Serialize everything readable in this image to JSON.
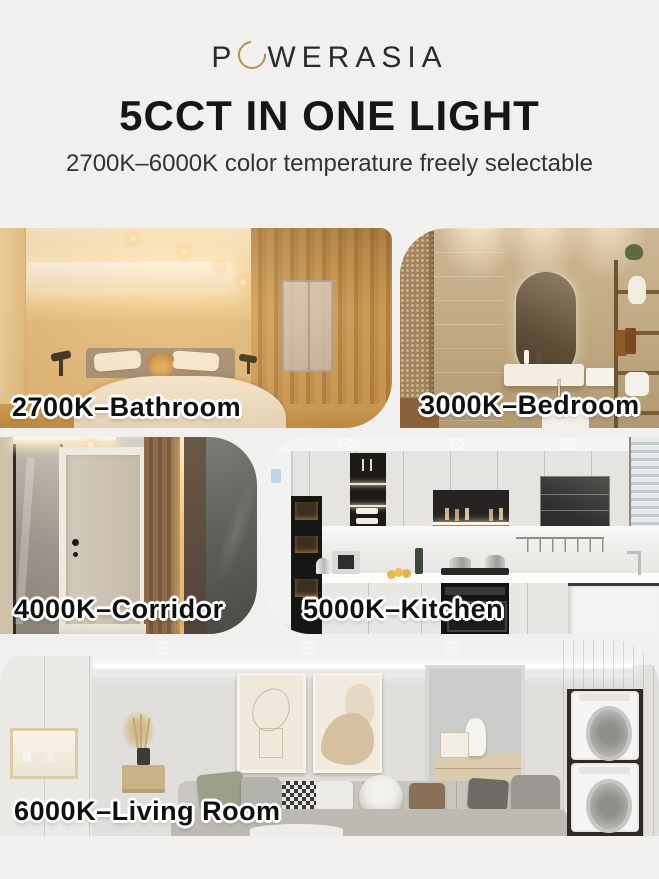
{
  "page": {
    "background": "#f1f0ee"
  },
  "brand": {
    "logo_pre_o": "P",
    "logo_post_o": "WERASIA",
    "logo_ring_color": "#b3924f",
    "logo_text_color": "#2b2b2b"
  },
  "header": {
    "title": "5CCT IN ONE LIGHT",
    "subtitle": "2700K–6000K color temperature freely selectable"
  },
  "scenes": [
    {
      "label": "2700K–Bathroom",
      "cct": "2700K",
      "room": "Bathroom",
      "tone_color": "#e3bd84"
    },
    {
      "label": "3000K–Bedroom",
      "cct": "3000K",
      "room": "Bedroom",
      "tone_color": "#c0a981"
    },
    {
      "label": "4000K–Corridor",
      "cct": "4000K",
      "room": "Corridor",
      "tone_color": "#d6d1c8"
    },
    {
      "label": "5000K–Kitchen",
      "cct": "5000K",
      "room": "Kitchen",
      "tone_color": "#edecea"
    },
    {
      "label": "6000K–Living Room",
      "cct": "6000K",
      "room": "Living Room",
      "tone_color": "#e0dfdb"
    }
  ]
}
